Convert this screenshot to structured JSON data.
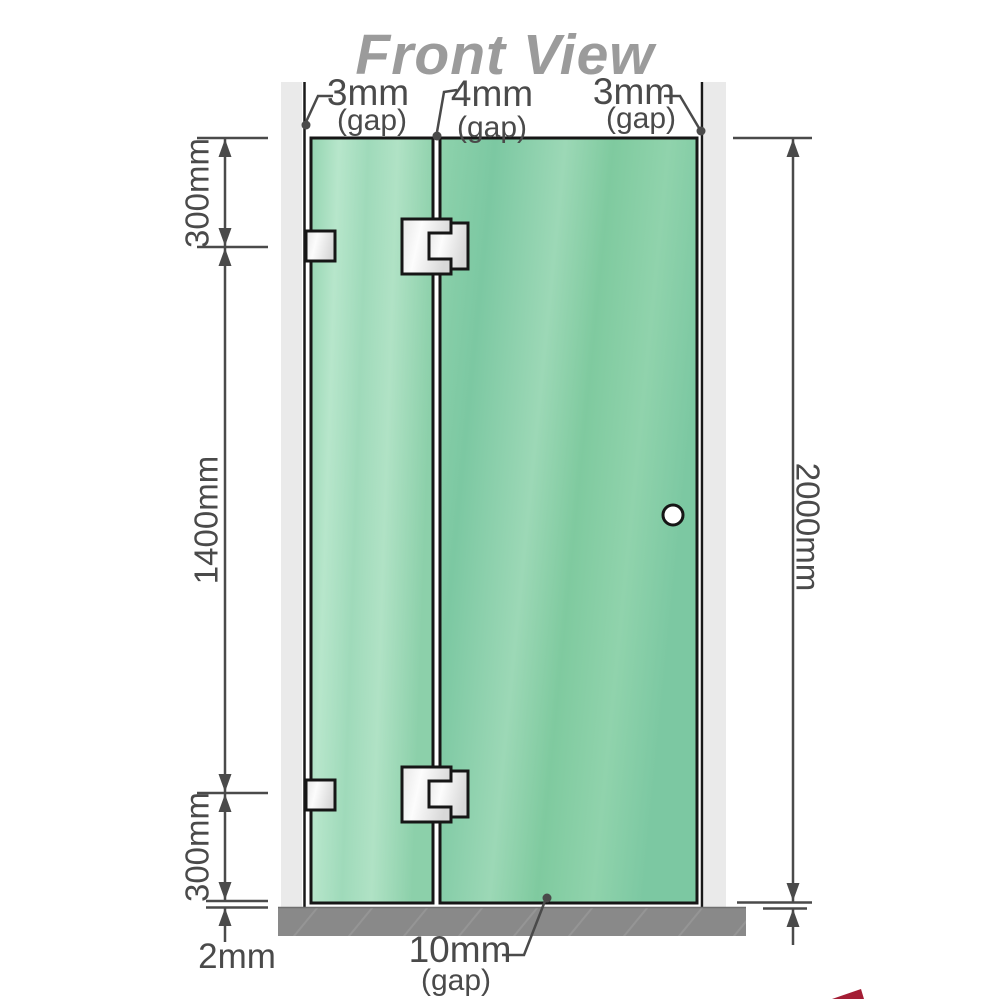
{
  "title": "Front View",
  "gaps": {
    "left": {
      "value": "3mm",
      "label": "(gap)"
    },
    "middle": {
      "value": "4mm",
      "label": "(gap)"
    },
    "right": {
      "value": "3mm",
      "label": "(gap)"
    },
    "bottom": {
      "value": "10mm",
      "label": "(gap)"
    }
  },
  "dimensions": {
    "left_top": "300mm",
    "left_middle": "1400mm",
    "left_bottom": "300mm",
    "floor_gap": "2mm",
    "right_total": "2000mm"
  },
  "colors": {
    "glass_green": "#7cc8a2",
    "glass_green_light": "#b7e6cb",
    "wall_channel_gray": "#eaeaea",
    "floor_gray": "#898989",
    "outline_black": "#161616",
    "dimension_gray": "#4a4a4a",
    "title_gray": "#9b9b9b"
  }
}
